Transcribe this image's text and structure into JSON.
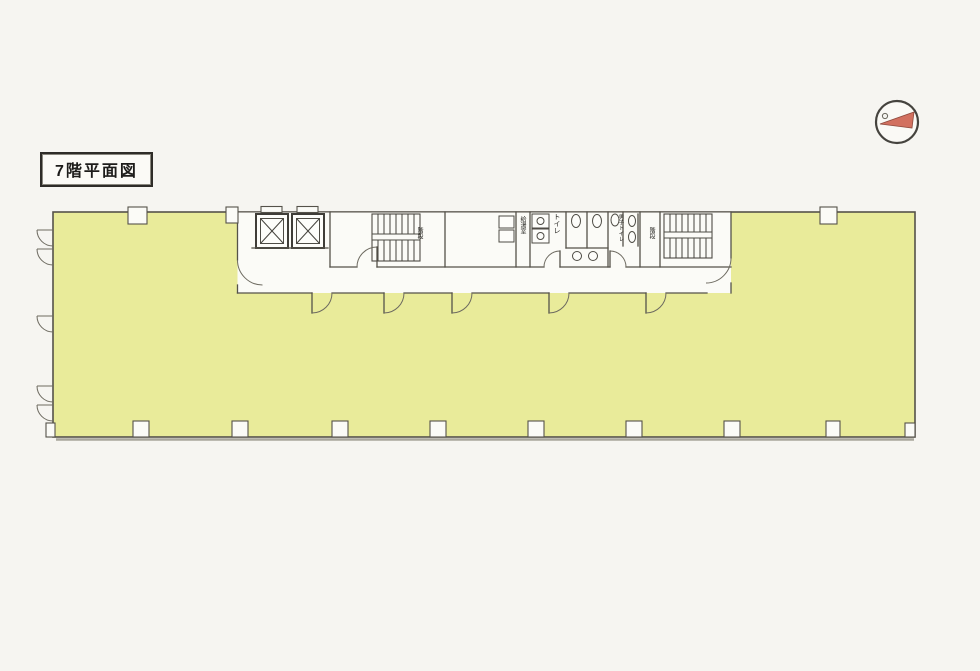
{
  "title_box": {
    "label": "7階平面図"
  },
  "compass": {
    "icon": "north-arrow-compass"
  },
  "floor_plan": {
    "labels": {
      "stairs_west": "階段",
      "kitchenette": "給湯室",
      "toilet": "トイレ",
      "toilet_men": "男子トイレ",
      "stairs_east": "階段"
    },
    "colors": {
      "page_background": "#f6f5f1",
      "floor_fill": "#e9eb9a",
      "core_fill": "#fbfbf7",
      "wall": "#55524a",
      "compass_arrow": "#d2705f"
    }
  }
}
